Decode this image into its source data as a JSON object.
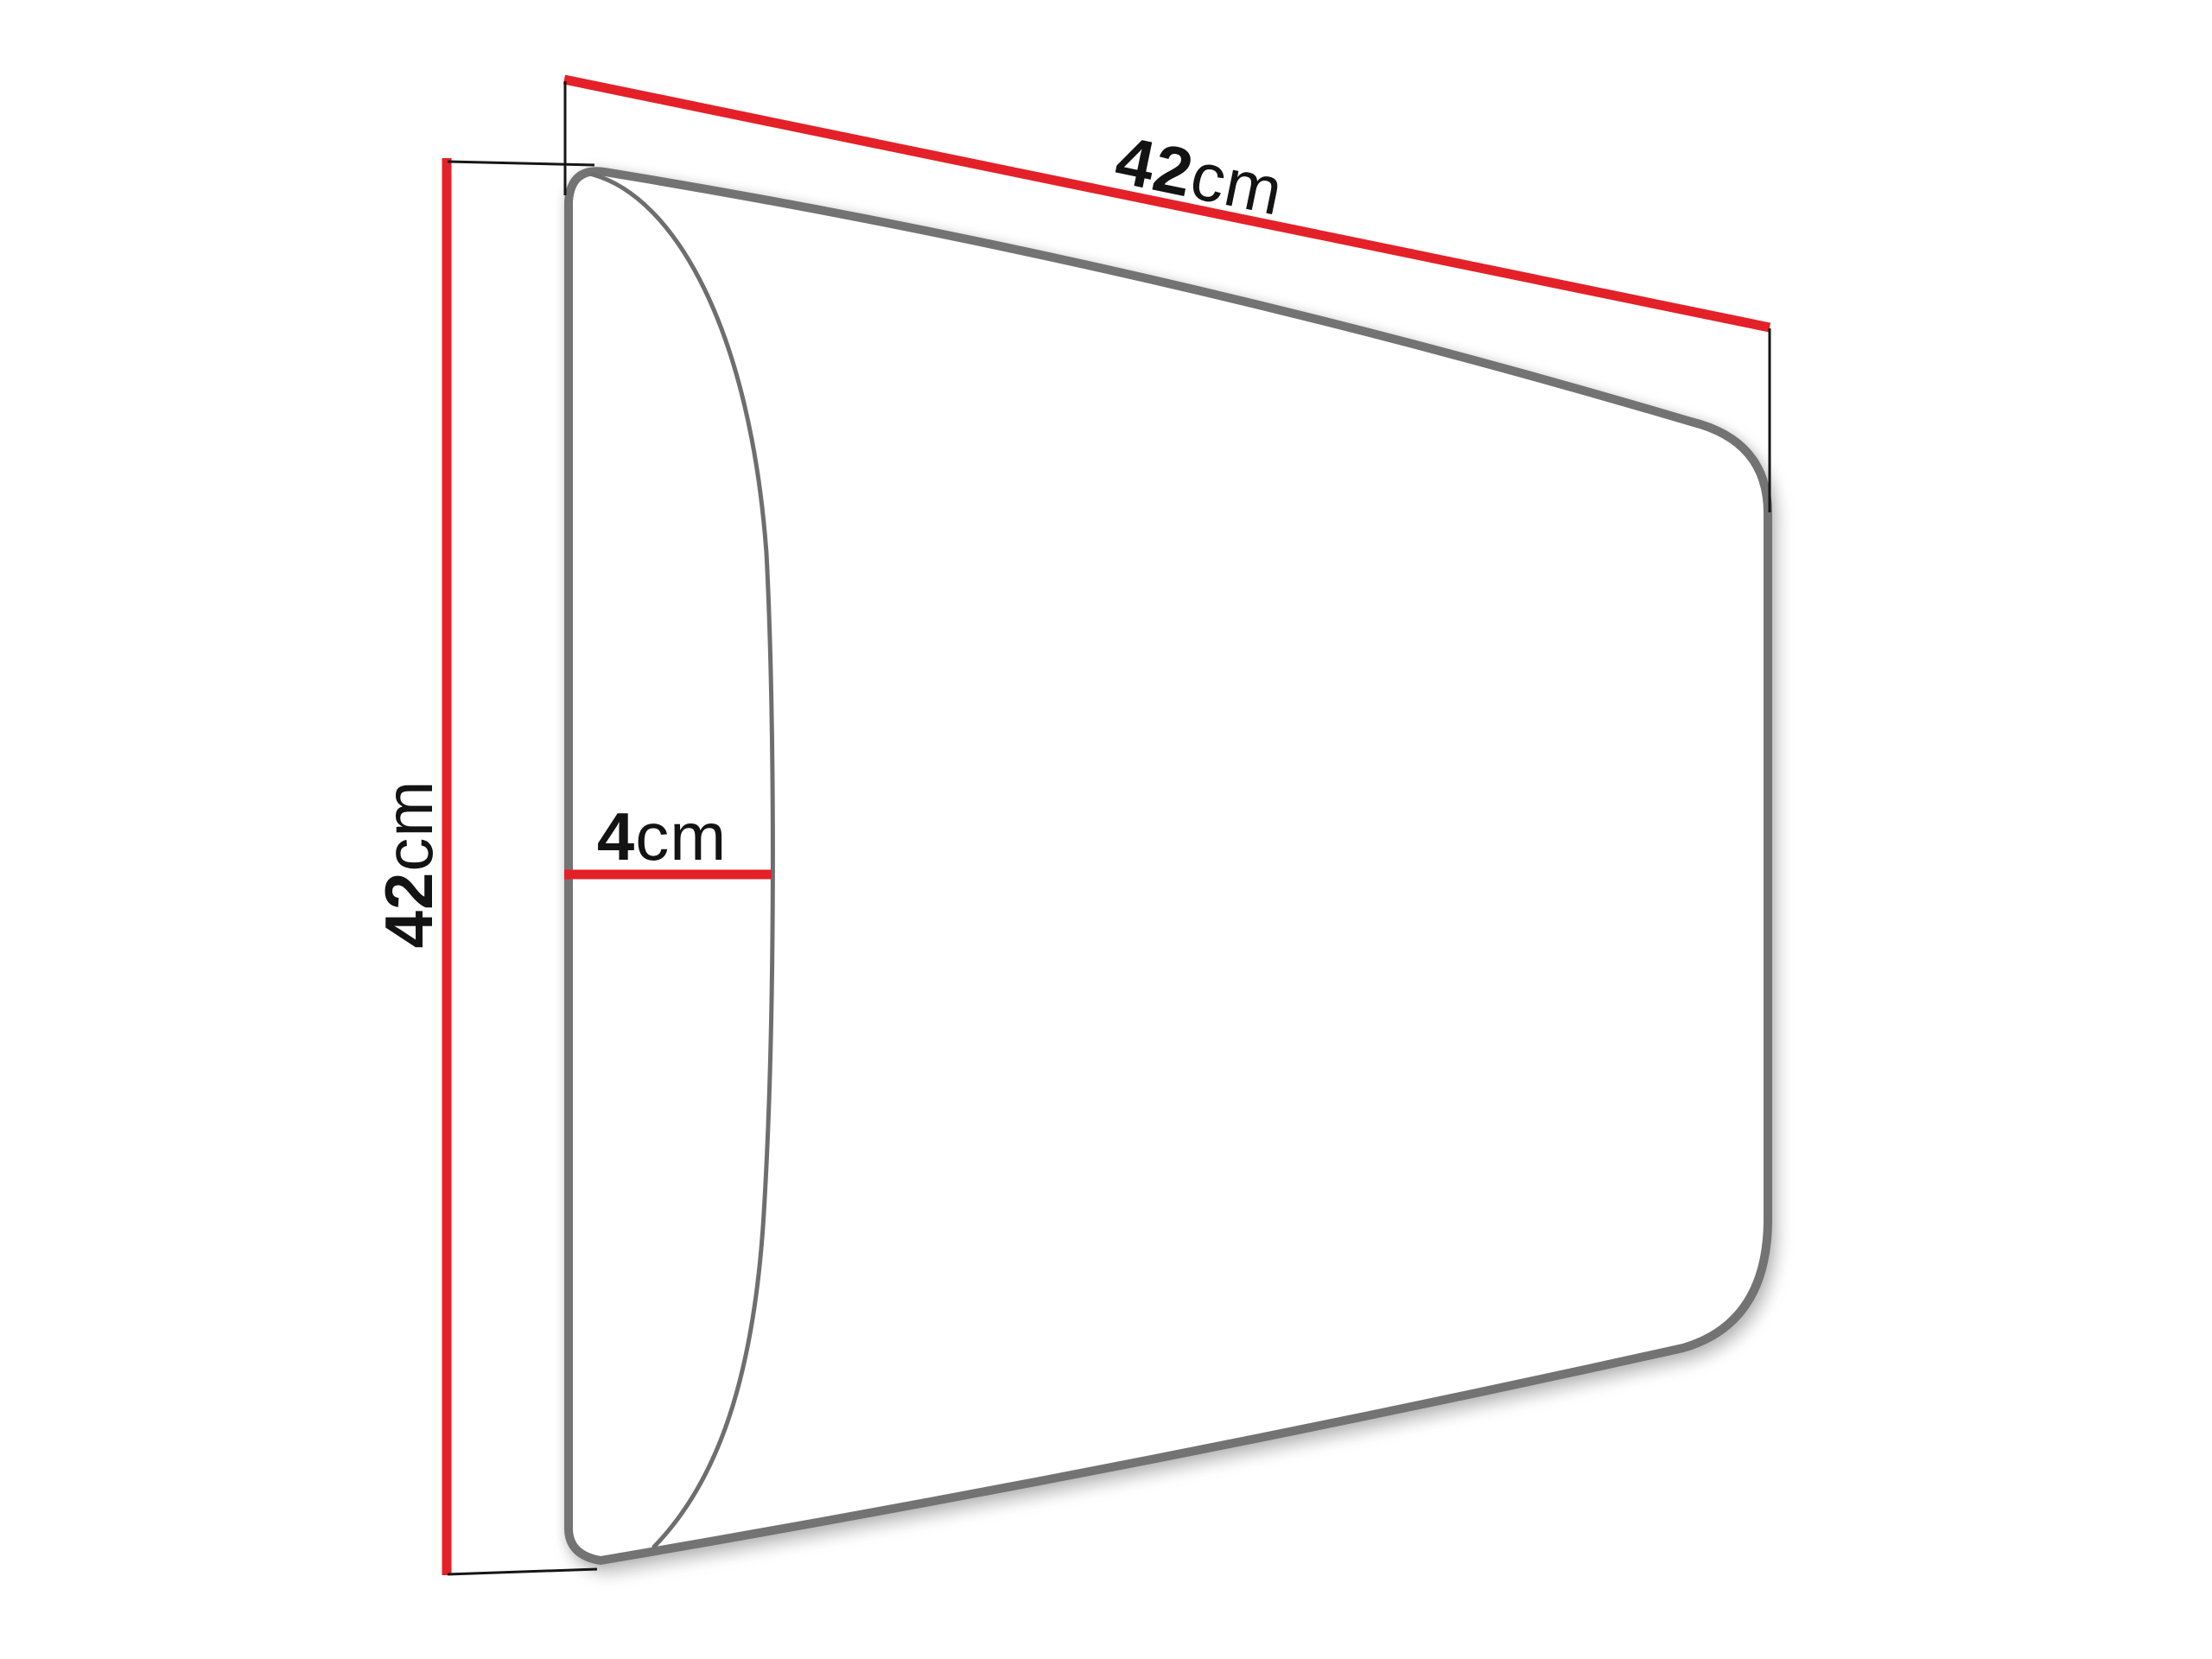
{
  "diagram": {
    "labels": {
      "width": {
        "value": "42",
        "unit": "cm"
      },
      "height": {
        "value": "42",
        "unit": "cm"
      },
      "depth": {
        "value": "4",
        "unit": "cm"
      }
    },
    "colors": {
      "dimension_line": "#e42128",
      "panel_outline": "#737373",
      "profile_curve": "#6e6e6e",
      "extension_line": "#161616",
      "label_text": "#131313",
      "panel_fill": "#ffffff"
    }
  }
}
